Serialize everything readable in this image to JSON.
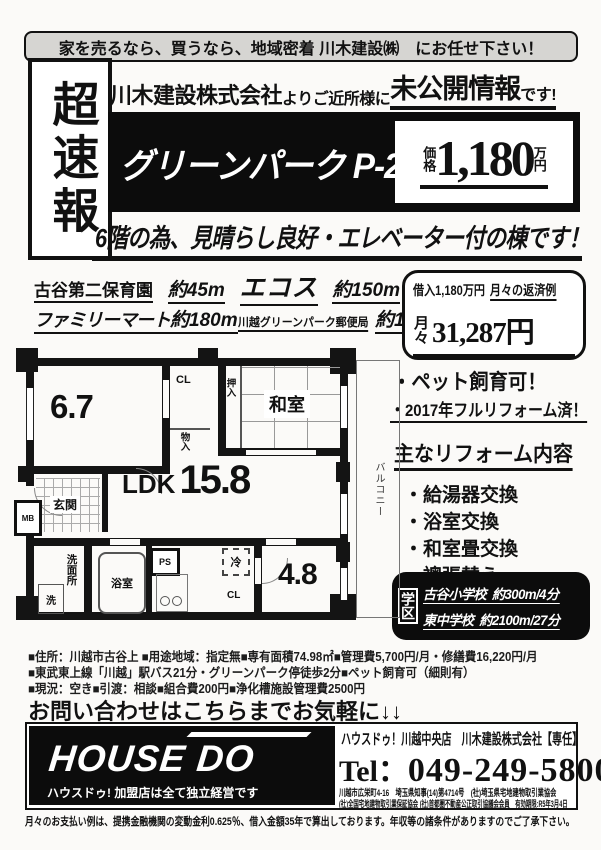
{
  "banner": {
    "text": "家を売るなら、買うなら、地域密着 川木建設㈱　にお任せ下さい！"
  },
  "header": {
    "flash_badge": "超速報",
    "company": "川木建設株式会社",
    "middle": "よりご近所様に",
    "highlight": "未公開情報",
    "suffix": "です!",
    "title": "グリーンパーク P-2棟",
    "price_label": "価格",
    "price_value": "1,180",
    "price_unit": "万円",
    "subtitle": "6階の為、見晴らし良好・エレベーター付の棟です！"
  },
  "facilities": {
    "row1": [
      {
        "name": "古谷第二保育園",
        "distance": "約45m"
      },
      {
        "name": "エコス",
        "distance": "約150m"
      }
    ],
    "row2": [
      {
        "name": "ファミリーマート",
        "distance": "約180m"
      },
      {
        "name": "川越グリーンパーク郵便局",
        "distance": "約180m"
      }
    ]
  },
  "loan": {
    "amount": "借入1,180万円",
    "example_label": "月々の返済例",
    "monthly_label": "月々",
    "monthly_value": "31,287円"
  },
  "features": [
    "・ペット飼育可！",
    "・2017年フルリフォーム済！"
  ],
  "reform": {
    "title": "主なリフォーム内容",
    "items": [
      "・給湯器交換",
      "・浴室交換",
      "・和室畳交換",
      "・襖張替え"
    ]
  },
  "school": {
    "label": "学区",
    "items": [
      {
        "name": "古谷小学校",
        "distance": "約300m/4分"
      },
      {
        "name": "東中学校",
        "distance": "約2100m/27分"
      }
    ]
  },
  "floorplan": {
    "room1": "6.7",
    "cl1": "CL",
    "monoire": "物入",
    "oshiire": "押入",
    "washitsu": "和室",
    "genkan": "玄関",
    "ldk_label": "LDK",
    "ldk_value": "15.8",
    "mb": "MB",
    "laundry": "洗",
    "senmenjo": "洗面所",
    "bath": "浴室",
    "ps": "PS",
    "fridge": "冷",
    "cl2": "CL",
    "room2": "4.8",
    "balcony": "バルコニー"
  },
  "details": {
    "line1": "■住所：川越市古谷上 ■用途地域：指定無■専有面積74.98㎡■管理費5,700円/月・修繕費16,220円/月",
    "line2": "■東武東上線「川越」駅バス21分・グリーンパーク停徒歩2分■ペット飼育可（細則有）",
    "line3": "■現況：空き■引渡：相談■組合費200円■浄化槽施設管理費2500円"
  },
  "contact": {
    "line": "お問い合わせはこちらまでお気軽に↓↓"
  },
  "footer": {
    "logo": "HOUSE DO",
    "logo_sub": "ハウスドゥ! 加盟店は全て独立経営です",
    "store_line": "ハウスドゥ！川越中央店　川木建設株式会社【専任】",
    "tel_label": "Tel：",
    "tel_number": "049-249-5800",
    "license_line1": "川越市広栄町4-16　埼玉県知事(14)第4714号　(社)埼玉県宅地建物取引業協会",
    "license_line2": "(社)全国宅地建物取引業保証協会 (社)首都圏不動産公正取引協議会会員　有効期限:R5年3月4日",
    "disclaimer": "月々のお支払い例は、提携金融機関の変動金利0.625％、借入金額35年で算出しております。年収等の諸条件がありますのでご了承下さい。"
  },
  "colors": {
    "ink": "#111111",
    "paper": "#fbfaf8",
    "banner_fill": "#d6d5d2"
  }
}
